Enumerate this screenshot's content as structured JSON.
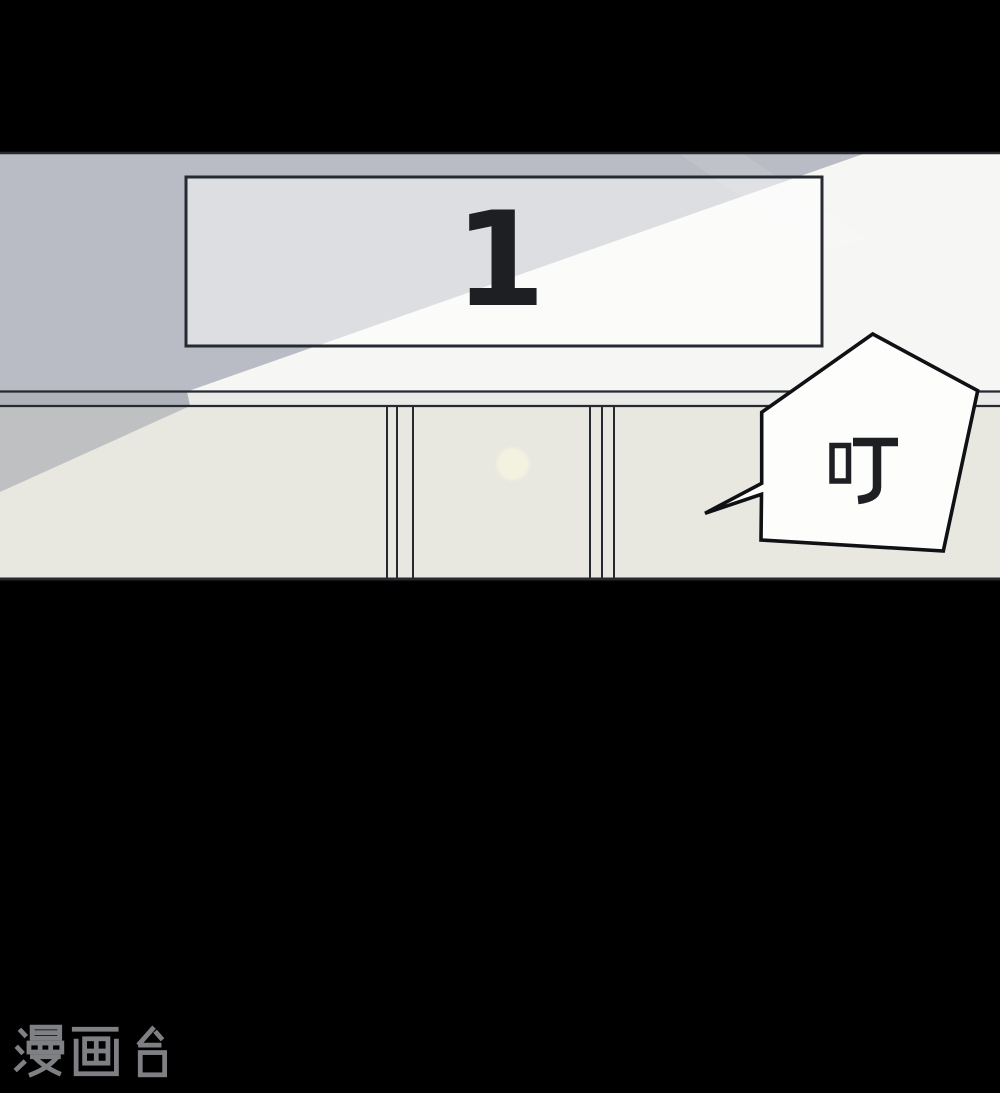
{
  "panel": {
    "floor_sign": {
      "text": "1"
    },
    "sfx_bubble": {
      "text": "叮"
    }
  },
  "watermark": {
    "text": "漫画台"
  },
  "colors": {
    "page_background": "#000000",
    "wall_light": "#f6f7f5",
    "shadow_overlay": "#5f657b",
    "door_wall": "#e8e8e1",
    "sign_border": "#252a33",
    "line_dark": "#26292f",
    "door_lamp": "#f3f2e0",
    "bubble_fill": "#fdfdfc",
    "bubble_stroke": "#101114",
    "ink": "#1d1f22",
    "watermark_color": "#7f8084"
  }
}
